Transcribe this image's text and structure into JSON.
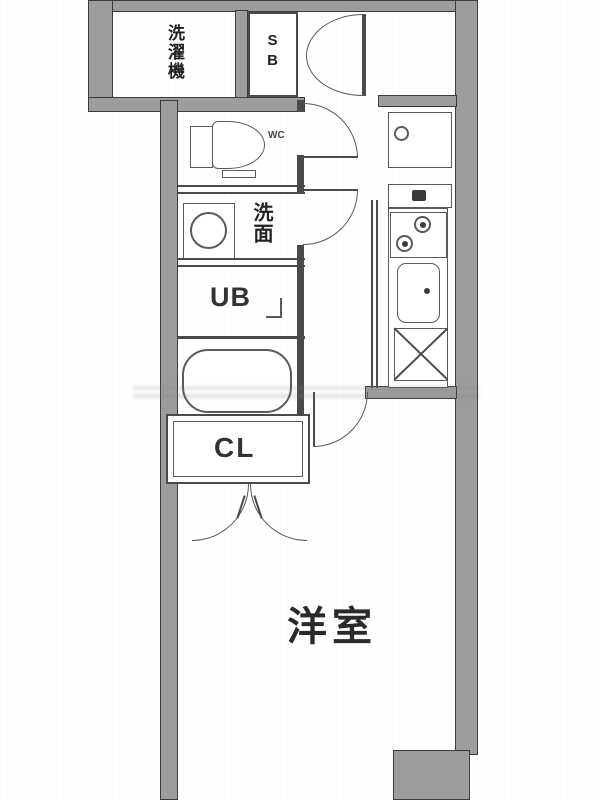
{
  "plan_title": "apartment-floor-plan",
  "colors": {
    "wall_fill": "#9d9d9d",
    "wall_outline": "#3c3c3c",
    "fixture_line": "#5a5a5a",
    "text": "#222222",
    "background": "#ffffff"
  },
  "labels": {
    "laundry": "洗濯機",
    "shoe_box": "SB",
    "toilet": "WC",
    "washbasin": "洗面",
    "unit_bath": "UB",
    "closet": "CL",
    "western_room": "洋室"
  },
  "fixtures": [
    "toilet",
    "washbasin",
    "bathtub",
    "stove",
    "kitchen-sink",
    "refrigerator-space",
    "washing-machine-pan",
    "shoe-box",
    "entrance-door"
  ]
}
